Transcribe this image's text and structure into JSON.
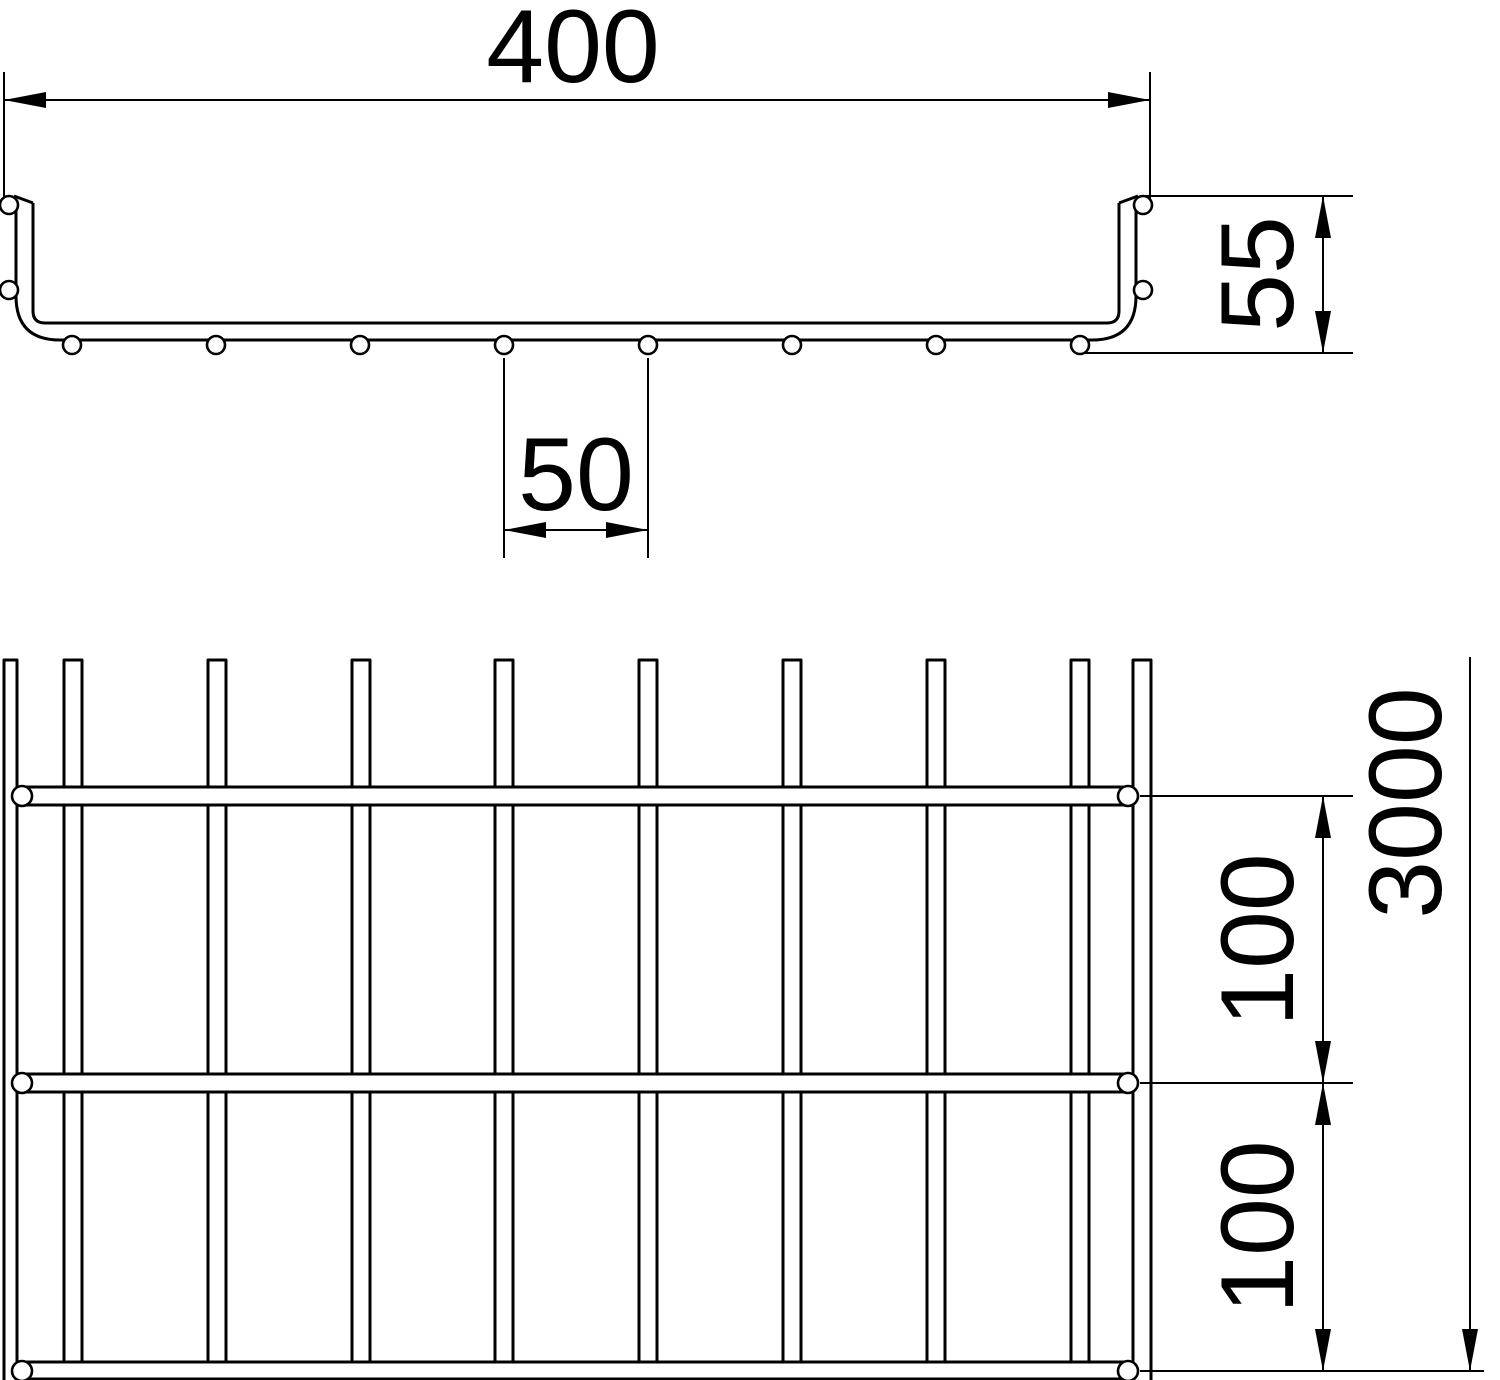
{
  "drawing": {
    "type": "wire-mesh-cable-tray-dimension-drawing",
    "background": "#ffffff",
    "line_color": "#000000",
    "views": {
      "cross_section": {
        "width_label": "400",
        "height_label": "55",
        "rung_pitch_label": "50",
        "rung_wire_count": 8,
        "side_wire_rows_per_wall": 2
      },
      "plan": {
        "length_label": "3000",
        "wire_offset_labels": [
          "100",
          "100"
        ],
        "rung_count": 8,
        "side_rail_count": 2,
        "longitudinal_wire_count": 3
      }
    }
  }
}
